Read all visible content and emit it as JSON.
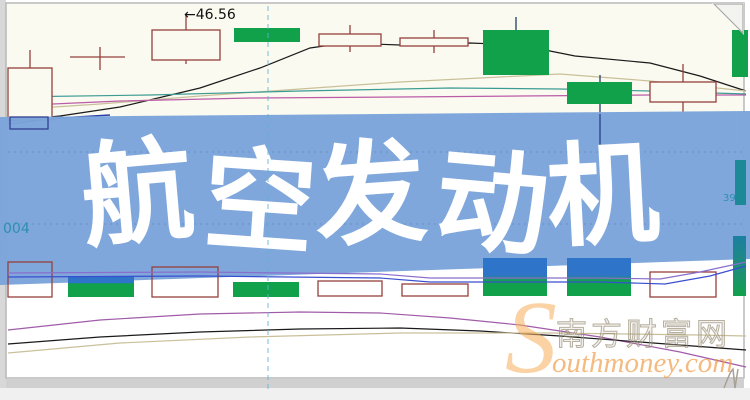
{
  "banner": {
    "title": "航空发动机",
    "bg_color": "#7BA4DA",
    "text_color": "#FFFFFF"
  },
  "labels": {
    "price_annotation": "←46.56",
    "left_partial_code": "004",
    "right_partial_value": "39",
    "label_color_teal": "#2E8FB0"
  },
  "watermark": {
    "initial": "S",
    "cn_text": "南方财富网",
    "en_text": "outhmoney.com",
    "orange": "#F0A050"
  },
  "chart_data": {
    "type": "candlestick",
    "units": "px",
    "grid": "off",
    "annotations": [
      {
        "text": "←46.56",
        "x": 190,
        "y": 19
      }
    ],
    "colors": {
      "bg_top": "#FAFAF0",
      "bg_bottom": "#FFFFFF",
      "up_hollow": "#96403C",
      "down_solid": "#12A14B",
      "wick_dark": "#1E3F66",
      "ma_black": "#1A1A1A",
      "ma_tan": "#C9C09A",
      "ma_teal": "#3C9C94",
      "ma_magenta": "#BB5CA8",
      "ma_navy": "#2B3FA8",
      "vol_violet": "#8A6ECC",
      "vol_blue": "#3A4FD0",
      "b_purple": "#A05CA8",
      "b_black": "#1A1A1A",
      "b_tan": "#C9C09A",
      "dashed_vline": "#5FB4D2"
    },
    "candles": [
      {
        "x": 8,
        "w": 44,
        "wick_x": 30,
        "body": [
          68,
          120
        ],
        "upper_wick": [
          50,
          68
        ],
        "style": "hollow"
      },
      {
        "style": "doji",
        "h_line": [
          70,
          125,
          57
        ],
        "v_line": [
          100,
          47,
          70
        ]
      },
      {
        "x": 152,
        "w": 68,
        "wick_x": 186,
        "body": [
          30,
          60
        ],
        "upper_wick": [
          14,
          30
        ],
        "lower_wick": [
          60,
          64
        ],
        "style": "hollow"
      },
      {
        "x": 234,
        "w": 66,
        "wick_x": 267,
        "body": [
          28,
          42
        ],
        "style": "solid"
      },
      {
        "x": 319,
        "w": 62,
        "wick_x": 350,
        "body": [
          34,
          46
        ],
        "upper_wick": [
          25,
          34
        ],
        "lower_wick": [
          46,
          52
        ],
        "style": "hollow"
      },
      {
        "x": 400,
        "w": 68,
        "wick_x": 434,
        "body": [
          38,
          46
        ],
        "upper_wick": [
          30,
          38
        ],
        "lower_wick": [
          46,
          53
        ],
        "style": "hollow"
      },
      {
        "x": 483,
        "w": 66,
        "wick_x": 516,
        "body": [
          30,
          75
        ],
        "upper_wick": [
          17,
          30
        ],
        "style": "solid"
      },
      {
        "x": 567,
        "w": 65,
        "wick_x": 600,
        "body": [
          82,
          104
        ],
        "upper_wick": [
          75,
          82
        ],
        "lower_wick": [
          104,
          113
        ],
        "style": "solid"
      },
      {
        "x": 650,
        "w": 66,
        "wick_x": 683,
        "body": [
          82,
          102
        ],
        "upper_wick": [
          64,
          82
        ],
        "lower_wick": [
          102,
          112
        ],
        "style": "hollow"
      },
      {
        "x": 732,
        "w": 16,
        "wick_x": 740,
        "body": [
          30,
          77
        ],
        "style": "solid"
      }
    ],
    "lines_top": [
      {
        "name": "ma-black",
        "color": "ma_black",
        "width": 1.2,
        "points": [
          [
            8,
            121
          ],
          [
            60,
            116
          ],
          [
            120,
            107
          ],
          [
            200,
            88
          ],
          [
            260,
            68
          ],
          [
            310,
            48
          ],
          [
            345,
            43
          ],
          [
            400,
            45
          ],
          [
            470,
            43
          ],
          [
            520,
            45
          ],
          [
            575,
            56
          ],
          [
            650,
            63
          ],
          [
            700,
            76
          ],
          [
            746,
            91
          ]
        ]
      },
      {
        "name": "ma-tan",
        "color": "ma_tan",
        "width": 1.2,
        "points": [
          [
            8,
            110
          ],
          [
            100,
            104
          ],
          [
            200,
            96
          ],
          [
            300,
            89
          ],
          [
            400,
            82
          ],
          [
            500,
            77
          ],
          [
            560,
            74
          ],
          [
            650,
            81
          ],
          [
            746,
            91
          ]
        ]
      },
      {
        "name": "ma-teal",
        "color": "ma_teal",
        "width": 1.2,
        "points": [
          [
            8,
            97
          ],
          [
            150,
            95
          ],
          [
            300,
            91
          ],
          [
            450,
            88
          ],
          [
            560,
            89
          ],
          [
            650,
            91
          ],
          [
            746,
            94
          ]
        ]
      },
      {
        "name": "ma-magenta",
        "color": "ma_magenta",
        "width": 1.2,
        "points": [
          [
            8,
            106
          ],
          [
            120,
            101
          ],
          [
            250,
            98
          ],
          [
            400,
            97
          ],
          [
            520,
            96
          ],
          [
            650,
            95
          ],
          [
            746,
            95
          ]
        ]
      },
      {
        "name": "ma-navy",
        "color": "ma_navy",
        "width": 1.4,
        "points": [
          [
            8,
            124
          ],
          [
            60,
            118
          ],
          [
            110,
            115
          ]
        ]
      }
    ],
    "volume_boxes": [
      {
        "x": 8,
        "w": 44,
        "y": 262,
        "h": 35
      },
      {
        "x": 152,
        "w": 66,
        "y": 267,
        "h": 30
      },
      {
        "x": 318,
        "w": 64,
        "y": 281,
        "h": 15
      },
      {
        "x": 402,
        "w": 66,
        "y": 284,
        "h": 12
      },
      {
        "x": 650,
        "w": 66,
        "y": 272,
        "h": 25
      }
    ],
    "volume_bars": [
      {
        "x": 68,
        "w": 66,
        "y": 276,
        "h": 21,
        "fill": "gradSplit"
      },
      {
        "x": 233,
        "w": 66,
        "y": 282,
        "h": 15,
        "fill": "#12A14B"
      },
      {
        "x": 483,
        "w": 64,
        "y": 258,
        "h": 38,
        "fill": "gradTall"
      },
      {
        "x": 567,
        "w": 64,
        "y": 258,
        "h": 38,
        "fill": "gradTall"
      },
      {
        "x": 733,
        "w": 13,
        "y": 236,
        "h": 60,
        "fill": "gradTeal"
      }
    ],
    "lines_bottom": [
      {
        "name": "vol-ma-violet",
        "color": "vol_violet",
        "width": 1.2,
        "points": [
          [
            8,
            273
          ],
          [
            200,
            272
          ],
          [
            380,
            274
          ],
          [
            430,
            278
          ],
          [
            600,
            278
          ],
          [
            660,
            279
          ],
          [
            700,
            272
          ],
          [
            746,
            262
          ]
        ]
      },
      {
        "name": "vol-ma-blue",
        "color": "vol_blue",
        "width": 1.2,
        "points": [
          [
            8,
            277
          ],
          [
            200,
            276
          ],
          [
            380,
            278
          ],
          [
            430,
            282
          ],
          [
            600,
            282
          ],
          [
            665,
            284
          ],
          [
            710,
            276
          ],
          [
            746,
            266
          ]
        ]
      },
      {
        "name": "indicator-purple",
        "color": "b_purple",
        "width": 1.2,
        "points": [
          [
            8,
            330
          ],
          [
            100,
            320
          ],
          [
            200,
            314
          ],
          [
            300,
            312
          ],
          [
            380,
            313
          ],
          [
            450,
            318
          ],
          [
            520,
            325
          ],
          [
            600,
            337
          ],
          [
            680,
            352
          ],
          [
            746,
            367
          ]
        ]
      },
      {
        "name": "indicator-black",
        "color": "b_black",
        "width": 1.2,
        "points": [
          [
            8,
            344
          ],
          [
            100,
            337
          ],
          [
            200,
            332
          ],
          [
            300,
            329
          ],
          [
            400,
            328
          ],
          [
            480,
            331
          ],
          [
            560,
            336
          ],
          [
            640,
            342
          ],
          [
            746,
            350
          ]
        ]
      },
      {
        "name": "indicator-tan",
        "color": "b_tan",
        "width": 1.2,
        "points": [
          [
            8,
            353
          ],
          [
            120,
            343
          ],
          [
            250,
            337
          ],
          [
            400,
            333
          ],
          [
            550,
            333
          ],
          [
            700,
            335
          ],
          [
            746,
            336
          ]
        ]
      }
    ],
    "overlays": {
      "navy_box": {
        "x": 10,
        "y": 117,
        "w": 38,
        "h": 12
      },
      "wick_through_banner": [
        600,
        114,
        160
      ],
      "teal_side_bar": {
        "x": 735,
        "y": 160,
        "w": 11,
        "h": 45
      },
      "dashed_vline_x": 268,
      "dotted_gridlines_y": [
        152,
        224
      ]
    }
  }
}
